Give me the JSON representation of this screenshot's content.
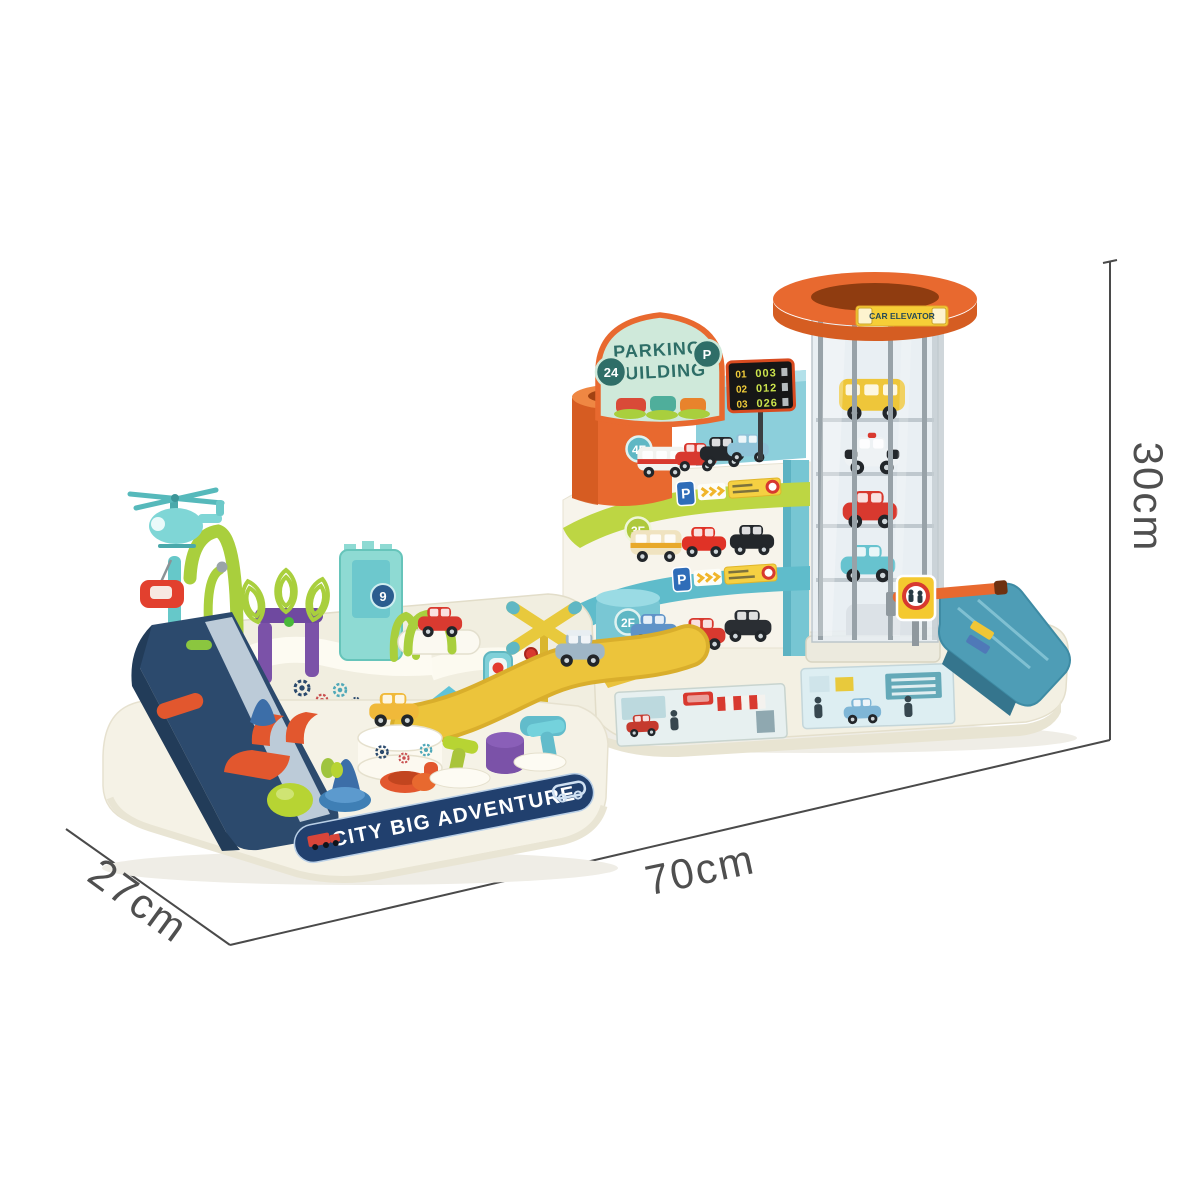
{
  "image": {
    "type": "toy-product-photo",
    "background": "#ffffff"
  },
  "dimensions": {
    "height": "30cm",
    "length": "70cm",
    "depth": "27cm"
  },
  "labels": {
    "banner": "CITY BIG ADVENTURE",
    "sign_line1": "PARKING",
    "sign_line2": "BUILDING",
    "sign_badge_left": "24",
    "sign_badge_right": "P",
    "floor4": "4F",
    "floor3": "3F",
    "floor2": "2F",
    "tower_badge": "9",
    "elevator": "CAR ELEVATOR",
    "p_sign_1": "P",
    "p_sign_2": "P"
  },
  "scoreboard": {
    "rows": [
      {
        "label": "01",
        "value": "003"
      },
      {
        "label": "02",
        "value": "012"
      },
      {
        "label": "03",
        "value": "026"
      }
    ]
  },
  "colors": {
    "cream": "#f3f0e3",
    "navy": "#2c4a6d",
    "banner_navy": "#21406e",
    "teal": "#5fbfce",
    "lime": "#b7d43a",
    "orange": "#e8692f",
    "red": "#d8392f",
    "yellow": "#ecc43b",
    "purple": "#7b52a8",
    "mint": "#cfe9da",
    "dim_line": "#4a4a4a"
  }
}
